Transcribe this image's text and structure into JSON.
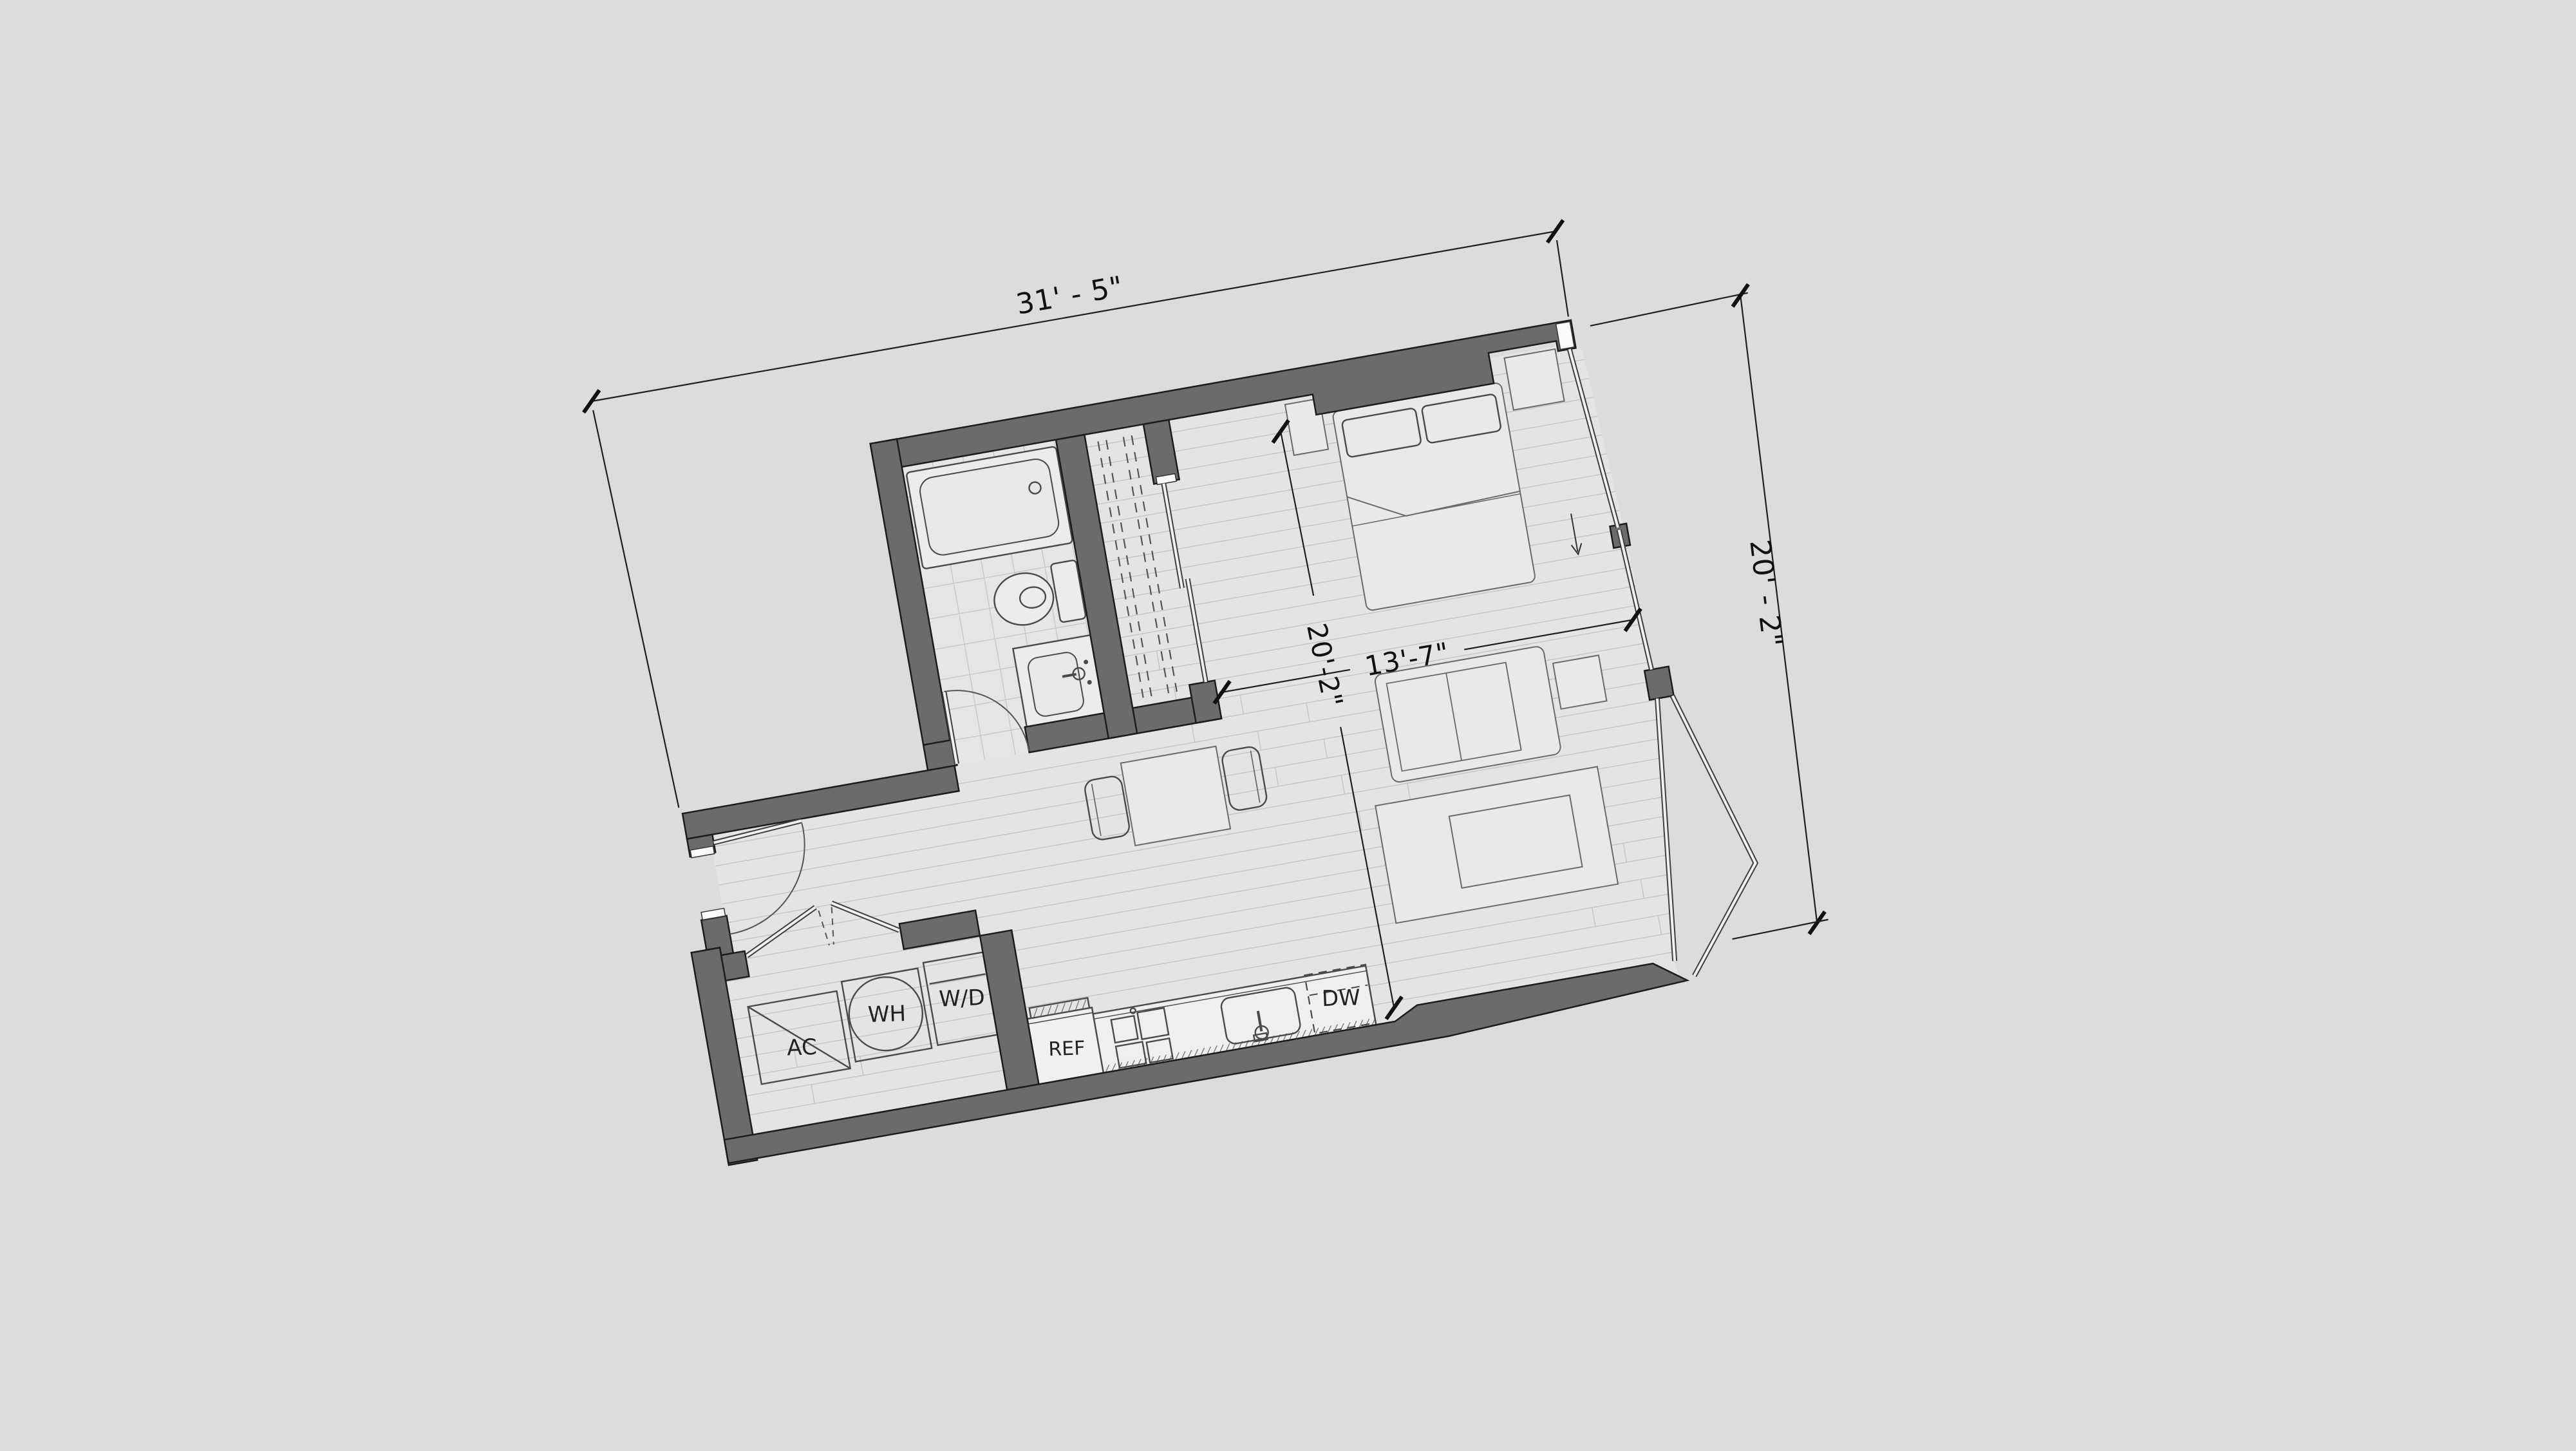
{
  "drawing": {
    "dimensions": {
      "overall_width": "31' - 5\"",
      "overall_height": "20' - 2\"",
      "interior_width": "13'-7\"",
      "interior_height": "20'-2\""
    },
    "labels": {
      "air_conditioner": "AC",
      "water_heater": "WH",
      "washer_dryer": "W/D",
      "refrigerator": "REF",
      "dishwasher": "DW"
    },
    "colors": {
      "background": "#dcdcdc",
      "floor": "#e4e4e4",
      "bath_floor": "#e6e6e6",
      "wall": "#6b6b6b",
      "line": "#1f1f1f"
    }
  }
}
